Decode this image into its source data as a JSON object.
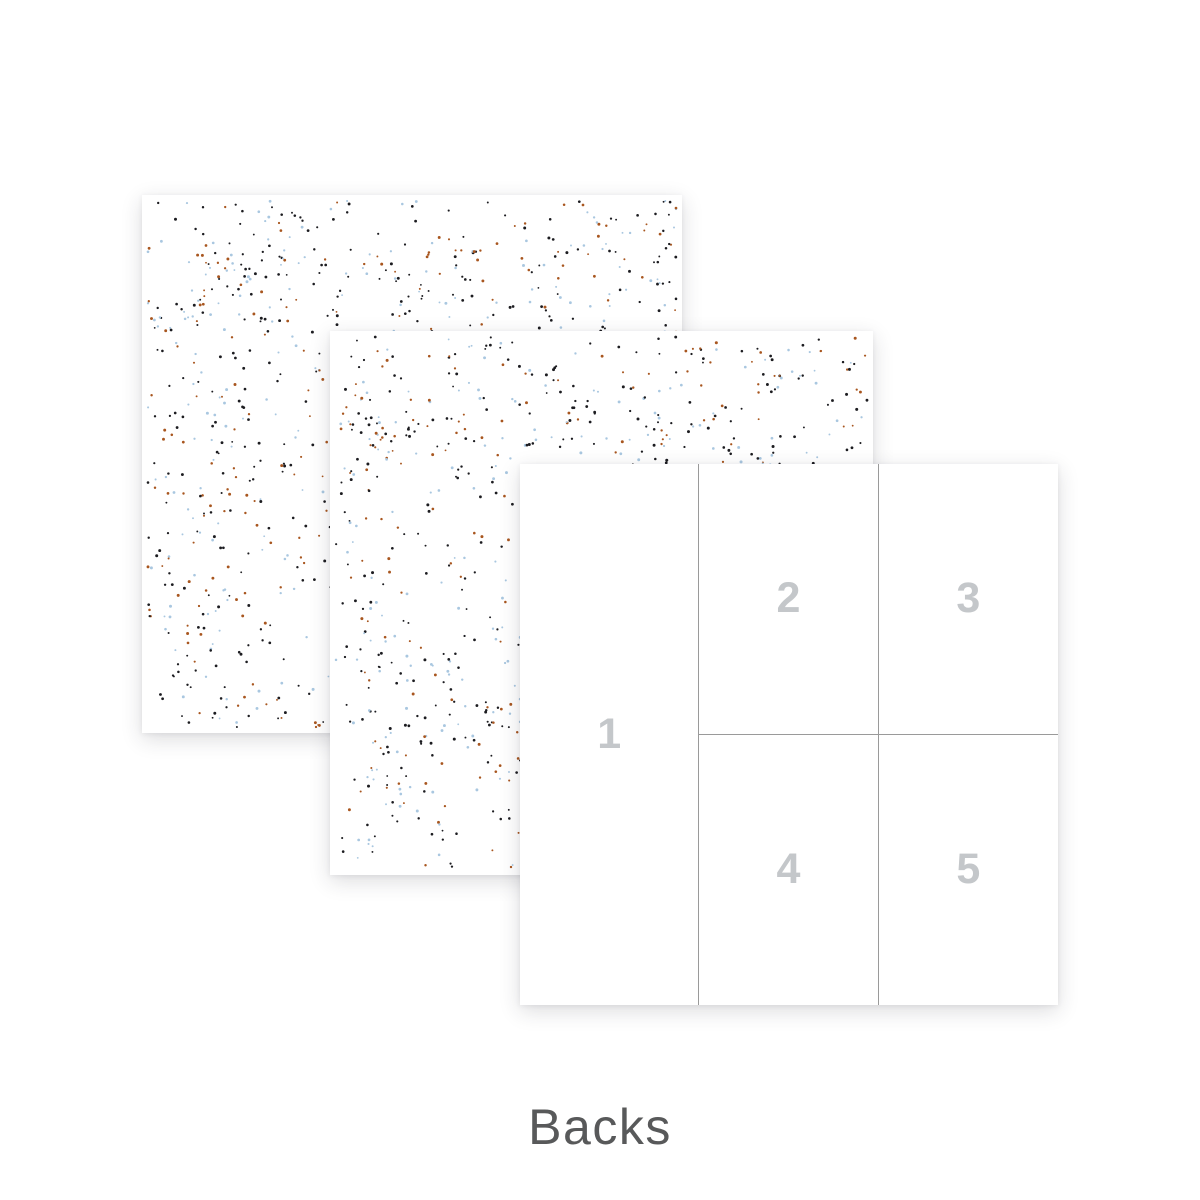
{
  "page": {
    "background_color": "#ffffff",
    "caption": "Backs",
    "caption_color": "#58595a"
  },
  "grid_paper": {
    "line_color": "#9a9a9a",
    "number_color": "#c4c7ca",
    "cells": [
      {
        "label": "1"
      },
      {
        "label": "2"
      },
      {
        "label": "3"
      },
      {
        "label": "4"
      },
      {
        "label": "5"
      }
    ]
  },
  "speckle_pattern": {
    "dot_count": 1200,
    "dot_radius_min": 0.9,
    "dot_radius_max": 1.5,
    "edge_inset": 6,
    "cluster_probability": 0.35,
    "cluster_spread": 18,
    "area": 540,
    "colors": [
      {
        "name": "ink-black",
        "hex": "#1c1c20",
        "weight": 0.46
      },
      {
        "name": "powder-blue",
        "hex": "#a9c7e0",
        "weight": 0.28
      },
      {
        "name": "rust-orange",
        "hex": "#a8561f",
        "weight": 0.26
      }
    ],
    "seeds": {
      "paper_1": 11,
      "paper_2": 47
    }
  }
}
